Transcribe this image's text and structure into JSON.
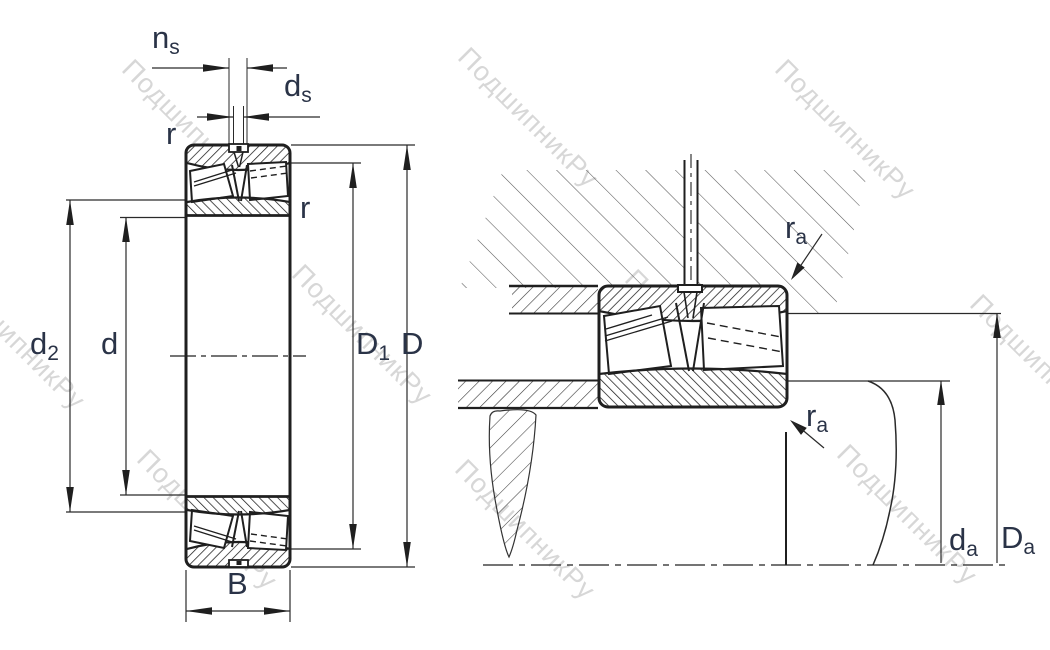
{
  "drawing_title": "spherical-roller-bearing-dimension-and-mounting-drawing",
  "colors": {
    "background": "#ffffff",
    "line_dark": "#1f1f1f",
    "line_thin": "#2a2a2a",
    "hatch_housing": "#5a5a5a",
    "label_text": "#2a3347",
    "watermark": "#d7d7d7"
  },
  "labels": {
    "ns": {
      "main": "n",
      "sub": "s"
    },
    "ds": {
      "main": "d",
      "sub": "s"
    },
    "r_top": {
      "main": "r",
      "sub": ""
    },
    "r_right": {
      "main": "r",
      "sub": ""
    },
    "d2": {
      "main": "d",
      "sub": "2"
    },
    "d": {
      "main": "d",
      "sub": ""
    },
    "D1": {
      "main": "D",
      "sub": "1"
    },
    "D": {
      "main": "D",
      "sub": ""
    },
    "B": {
      "main": "B",
      "sub": ""
    },
    "ra_top": {
      "main": "r",
      "sub": "a"
    },
    "ra_bot": {
      "main": "r",
      "sub": "a"
    },
    "da": {
      "main": "d",
      "sub": "a"
    },
    "Da": {
      "main": "D",
      "sub": "a"
    }
  },
  "watermark": {
    "text": "ПодшипникРу",
    "positions": [
      {
        "x": 192,
        "y": 130
      },
      {
        "x": 528,
        "y": 118
      },
      {
        "x": 845,
        "y": 130
      },
      {
        "x": 15,
        "y": 340
      },
      {
        "x": 362,
        "y": 335
      },
      {
        "x": 695,
        "y": 340
      },
      {
        "x": 1040,
        "y": 365
      },
      {
        "x": 207,
        "y": 520
      },
      {
        "x": 525,
        "y": 530
      },
      {
        "x": 907,
        "y": 515
      }
    ]
  }
}
